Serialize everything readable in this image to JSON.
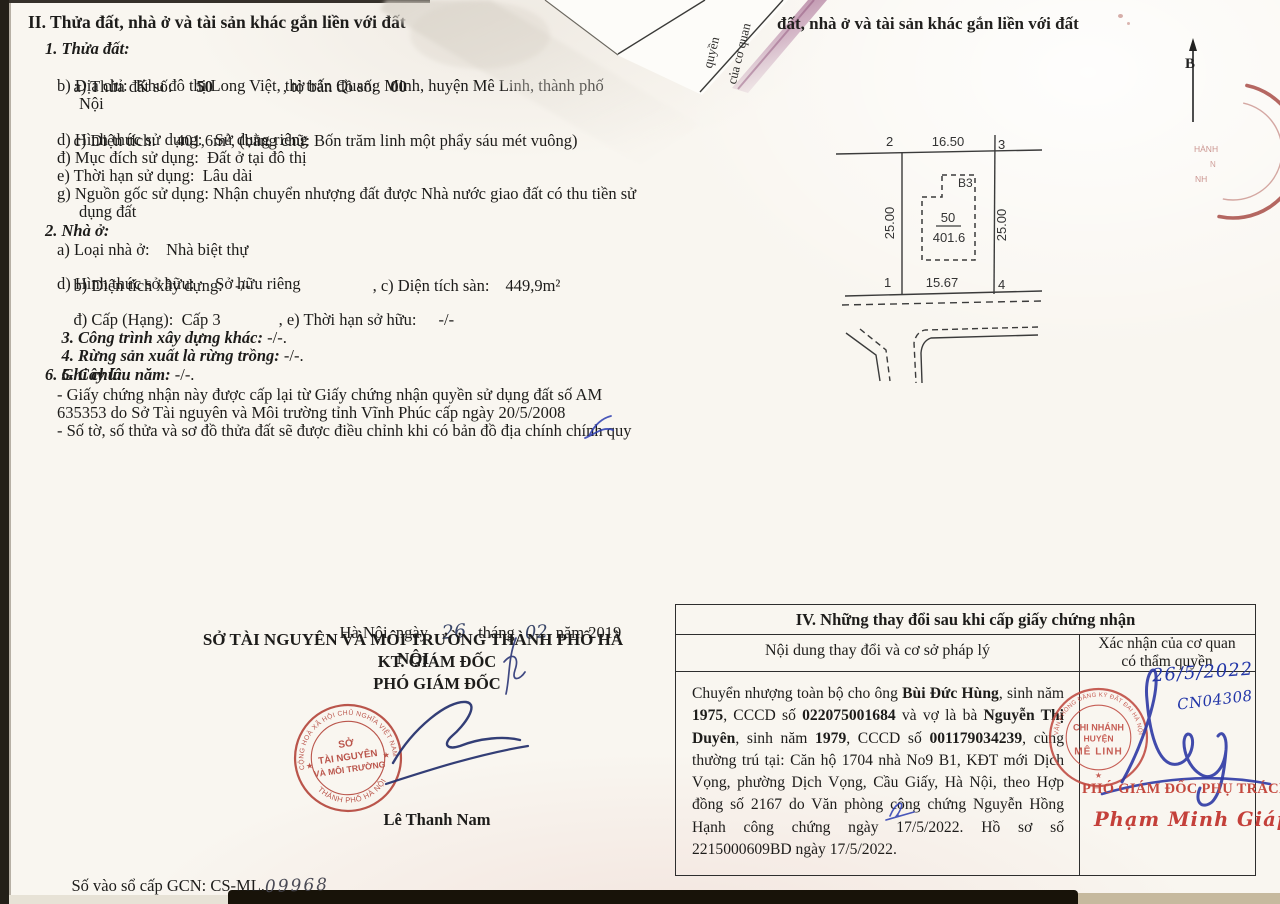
{
  "colors": {
    "stamp_red": "#b5483e",
    "ink_blue": "#2c39a4",
    "text": "#1d1c1a"
  },
  "document": {
    "section2": {
      "heading": "II. Thửa đất, nhà ở và tài sản khác gắn liền với đất",
      "parcel_title": "1. Thửa đất:",
      "a_label": "a) Thửa đất số:",
      "a_value": "50",
      "a_label2": ", tờ bản đồ số:",
      "a_value2": "00",
      "b_line1": "b) Địa chỉ:  Khu đô thị Long Việt, thị trấn Quang Minh, huyện Mê Linh, thành phố",
      "b_line2": "Nội",
      "c_label": "c) Diện tích:",
      "c_value": "401,6m², (bằng chữ: Bốn trăm linh một phẩy sáu mét vuông)",
      "d_line": "d) Hình thức sử dụng:   Sử dụng riêng",
      "dd_line": "đ) Mục đích sử dụng:  Đất ở tại đô thị",
      "e_line": "e) Thời hạn sử dụng:  Lâu dài",
      "g_line1": "g) Nguồn gốc sử dụng: Nhận chuyển nhượng đất được Nhà nước giao đất có thu tiền sử",
      "g_line2": "dụng đất",
      "house_title": "2. Nhà ở:",
      "h_a": "a) Loại nhà ở:    Nhà biệt thự",
      "h_b1": "b) Diện tích xây dựng:   -/-",
      "h_b2": ", c) Diện tích sàn:",
      "h_b3": "449,9m²",
      "h_d": "d) Hình thức sở hữu:     Sở hữu riêng",
      "h_dd1": "đ) Cấp (Hạng):  Cấp 3",
      "h_dd2": ", e) Thời hạn sở hữu:",
      "h_dd3": "-/-",
      "s3_label": "3. Công trình xây dựng khác:",
      "s3_value": " -/-.",
      "s4_label": "4. Rừng sản xuất là rừng trồng:",
      "s4_value": " -/-.",
      "s5_label": "5. Cây lâu năm:",
      "s5_value": " -/-.",
      "s6_label": "6. Ghi chú:",
      "note1_line1": "- Giấy chứng nhận này được cấp lại từ Giấy chứng nhận quyền sử dụng đất số AM",
      "note1_line2": "635353 do Sở Tài nguyên và Môi trường tỉnh Vĩnh Phúc cấp ngày 20/5/2008",
      "note2": "- Số tờ, số thửa và sơ đồ thửa đất sẽ được điều chỉnh khi có bản đồ địa chính chính quy"
    },
    "overlap": {
      "header_repeat": "đất, nhà ở và tài sản khác gắn liền với đất",
      "back_text_line1": "của cơ quan",
      "back_text_line2": "quyền"
    },
    "compass_label": "B",
    "sketch": {
      "corner1": "1",
      "corner2": "2",
      "corner3": "3",
      "corner4": "4",
      "edge_top": "16.50",
      "edge_bottom": "15.67",
      "edge_left": "25.00",
      "edge_right": "25.00",
      "block": "B3",
      "parcel": "50",
      "area": "401.6"
    },
    "issuer": {
      "date_prefix": "Hà Nội, ngày",
      "day": "26",
      "month_label": "tháng",
      "month": "02",
      "year_label": "năm 2019",
      "department": "SỞ TÀI NGUYÊN VÀ MÔI TRƯỜNG THÀNH PHỐ HÀ NỘI",
      "on_behalf": "KT. GIÁM ĐỐC",
      "title": "PHÓ GIÁM ĐỐC",
      "signer": "Lê Thanh Nam"
    },
    "registry": {
      "label": "Số vào sổ cấp GCN: CS-ML.",
      "number": "09968"
    },
    "section4": {
      "title": "IV. Những thay đổi sau khi cấp giấy chứng nhận",
      "col_content": "Nội dung thay đổi và cơ sở pháp lý",
      "col_confirm_1": "Xác nhận của cơ quan",
      "col_confirm_2": "có thẩm quyền",
      "content": {
        "s1": "Chuyển nhượng toàn bộ cho ông ",
        "s2": "Bùi Đức Hùng",
        "s3": ", sinh năm ",
        "s4": "1975",
        "s5": ", CCCD số ",
        "s6": "022075001684",
        "s7": " và vợ là bà ",
        "s8": "Nguyễn Thị Duyên",
        "s9": ", sinh năm ",
        "s10": "1979",
        "s11": ", CCCD số ",
        "s12": "001179034239",
        "s13": ", cùng thường trú tại: Căn hộ 1704 nhà No9 B1, KĐT mới Dịch Vọng, phường Dịch Vọng, Cầu Giấy, Hà Nội, theo Hợp đồng số 2167 do Văn phòng công chứng Nguyễn Hồng Hạnh công chứng ngày 17/5/2022. Hồ sơ số 2215000609BD ngày 17/5/2022."
      },
      "hw_date": "26/5/2022",
      "hw_code": "CN04308",
      "approver_title": "PHÓ GIÁM ĐỐC PHỤ TRÁCH",
      "approver_name": "Phạm Minh Giáp"
    },
    "stamps": {
      "dept": {
        "ring_top": "CỘNG HOÀ XÃ HỘI CHỦ NGHĨA VIỆT NAM",
        "center1": "SỞ",
        "center2": "TÀI NGUYÊN",
        "center3": "VÀ MÔI TRƯỜNG",
        "ring_bottom": "THÀNH PHỐ HÀ NỘI",
        "star_left": "★",
        "star_right": "★"
      },
      "branch": {
        "ring": "VĂN PHÒNG ĐĂNG KÝ ĐẤT ĐAI HÀ NỘI",
        "center1": "CHI NHÁNH",
        "center2": "HUYỆN",
        "center3": "MÊ LINH",
        "star": "★"
      },
      "corner": {
        "frag1": "HÀNH",
        "frag2": "N",
        "frag3": "NH"
      }
    }
  }
}
